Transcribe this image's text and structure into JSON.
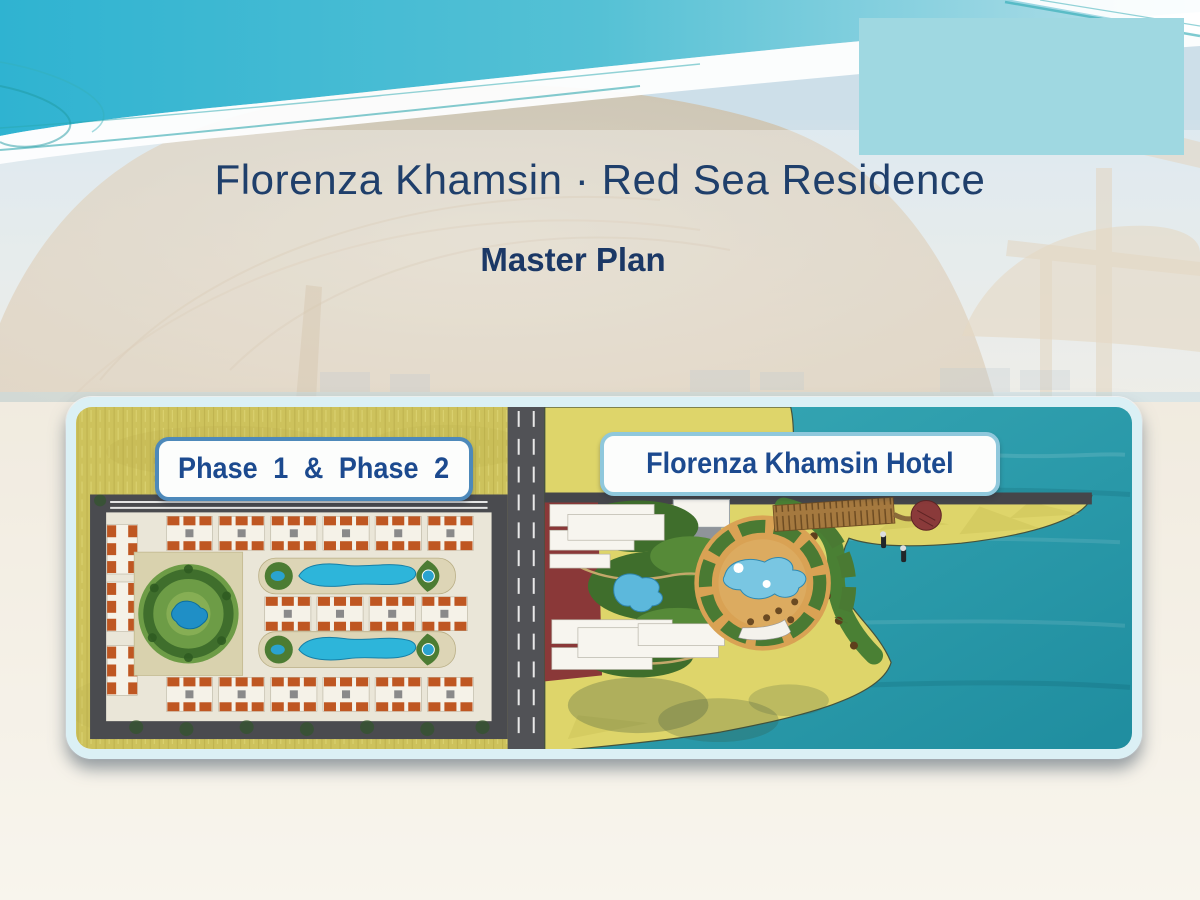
{
  "slide": {
    "title": "Florenza Khamsin · Red Sea Residence",
    "subtitle": "Master Plan"
  },
  "master_plan": {
    "phase_label": "Phase 1 & Phase 2",
    "hotel_label": "Florenza Khamsin Hotel"
  },
  "colors": {
    "title_text": "#1f3f6b",
    "label_text": "#1c4a8f",
    "logo_box": "#9fd8e1",
    "sky_turquoise": "#2fb3d1",
    "sea_teal": "#2a9dab",
    "plan_grass": "#cdc25c",
    "plan_sand": "#ded56a",
    "roof_orange": "#bf5722",
    "pool_blue": "#2db5da",
    "hotel_maroon": "#8a3838",
    "frame_border": "#dbf0f5"
  }
}
